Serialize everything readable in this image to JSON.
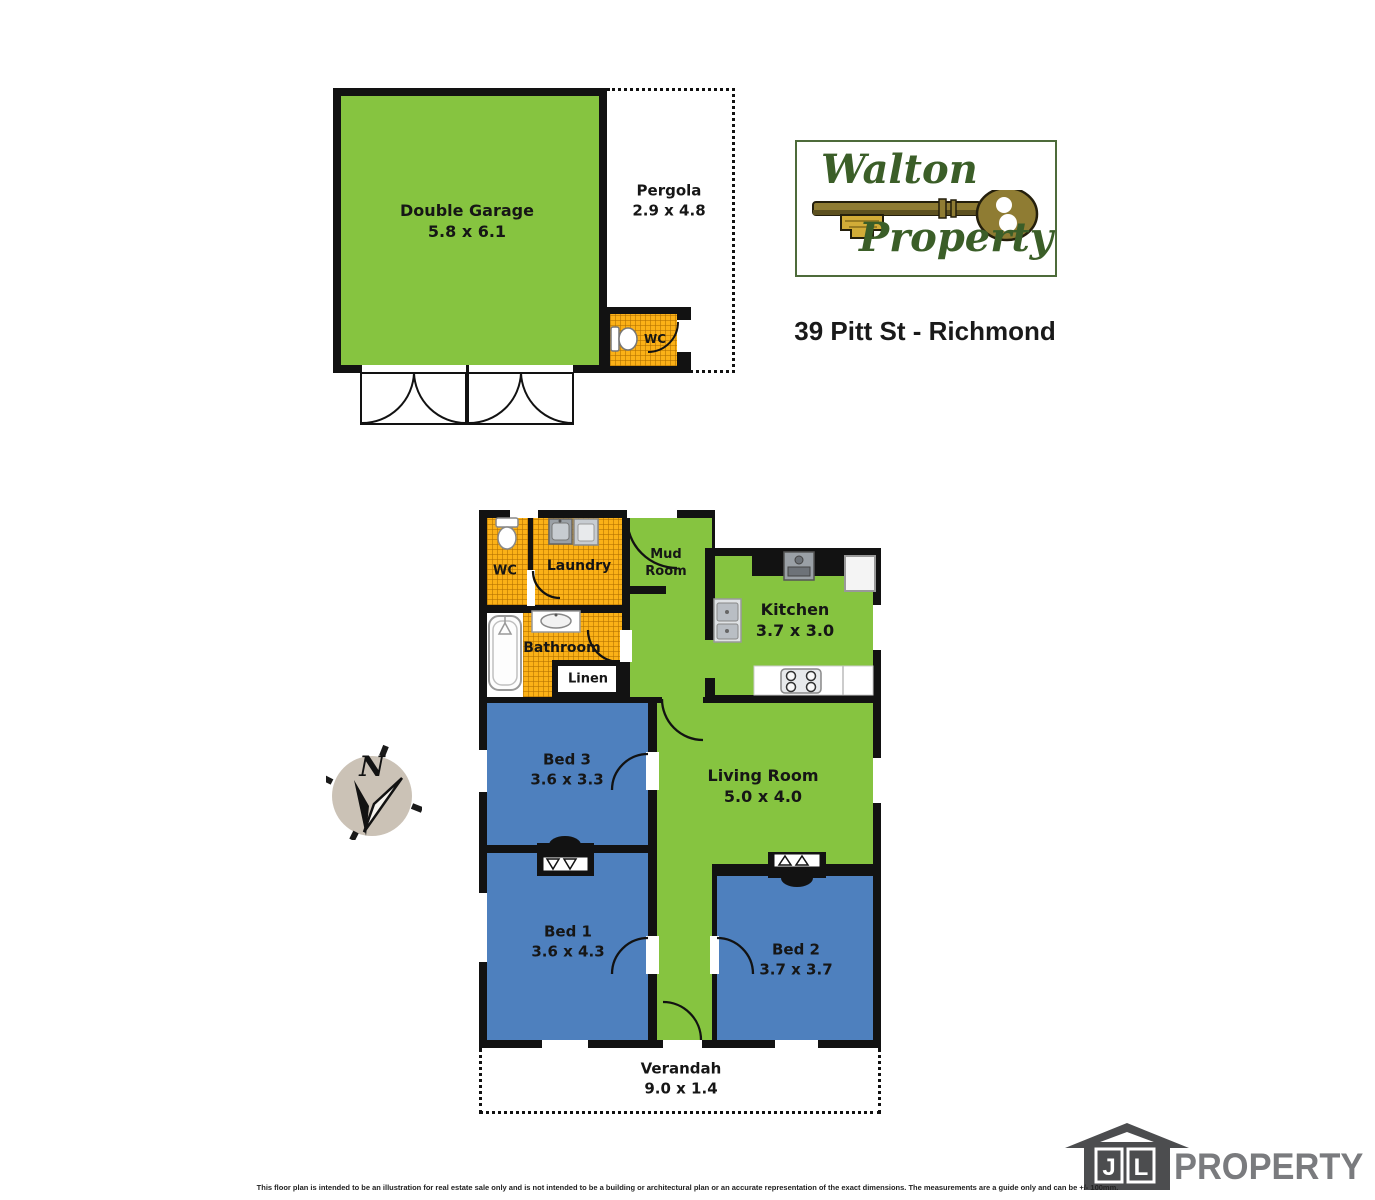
{
  "header": {
    "agency_logo": {
      "name_top": "Walton",
      "name_bottom": "Property"
    },
    "address": "39 Pitt St - Richmond"
  },
  "garage_plan": {
    "double_garage": {
      "name": "Double Garage",
      "dims": "5.8 x 6.1"
    },
    "pergola": {
      "name": "Pergola",
      "dims": "2.9 x 4.8"
    },
    "wc": {
      "name": "WC"
    }
  },
  "floor_plan": {
    "wc": {
      "name": "WC"
    },
    "laundry": {
      "name": "Laundry"
    },
    "mud_room": {
      "line1": "Mud",
      "line2": "Room"
    },
    "kitchen": {
      "name": "Kitchen",
      "dims": "3.7 x 3.0"
    },
    "bathroom": {
      "name": "Bathroom"
    },
    "linen": {
      "name": "Linen"
    },
    "bed3": {
      "name": "Bed 3",
      "dims": "3.6 x 3.3"
    },
    "living_room": {
      "name": "Living Room",
      "dims": "5.0 x 4.0"
    },
    "bed1": {
      "name": "Bed 1",
      "dims": "3.6 x 4.3"
    },
    "bed2": {
      "name": "Bed 2",
      "dims": "3.7 x 3.7"
    },
    "verandah": {
      "name": "Verandah",
      "dims": "9.0 x 1.4"
    }
  },
  "compass": {
    "north": "N"
  },
  "footer": {
    "logo": {
      "j": "J",
      "l": "L",
      "brand": "PROPERTY"
    },
    "disclaimer": "This floor plan is intended to be an illustration for real estate sale only and is not intended to be a building or architectural plan or an accurate representation of the exact dimensions. The measurements are a guide only and can be +/- 100mm."
  },
  "colors": {
    "room_green": "#86C440",
    "room_blue": "#4E80BE",
    "tile_orange": "#FBB117",
    "wall_black": "#121212",
    "logo_green": "#3B5E28",
    "compass_fill": "#CBC2B6",
    "jl_house_gray": "#4C4D4F",
    "jl_text_gray": "#7A7B7E"
  }
}
